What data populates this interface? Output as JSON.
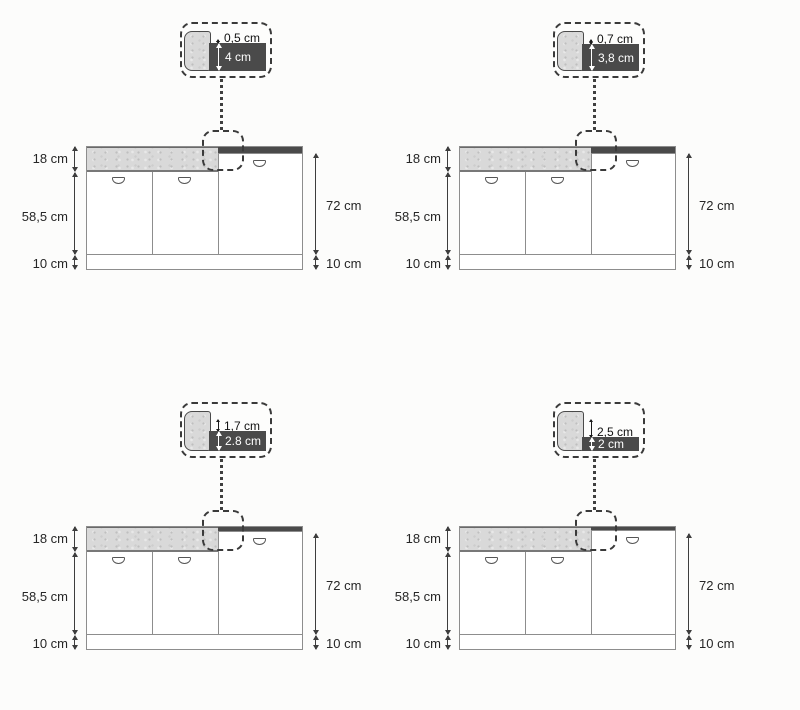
{
  "colors": {
    "worktop_dark": "#4a4a4a",
    "counter_gray": "#d9d9d9",
    "dashed_outline": "#3a3a3a",
    "dimension_line": "#3d3d3d",
    "background": "#fcfcfb"
  },
  "diagrams": [
    {
      "callout": {
        "step_label": "0,5 cm",
        "step_cm": 0.5,
        "thickness_label": "4 cm",
        "thickness_cm": 4
      },
      "worktop_cm": 4,
      "dims": {
        "top_section": "18 cm",
        "doors": "58,5 cm",
        "plinth_left": "10 cm",
        "right_height": "72 cm",
        "plinth_right": "10 cm"
      }
    },
    {
      "callout": {
        "step_label": "0,7 cm",
        "step_cm": 0.7,
        "thickness_label": "3,8 cm",
        "thickness_cm": 3.8
      },
      "worktop_cm": 3.8,
      "dims": {
        "top_section": "18 cm",
        "doors": "58,5 cm",
        "plinth_left": "10 cm",
        "right_height": "72 cm",
        "plinth_right": "10 cm"
      }
    },
    {
      "callout": {
        "step_label": "1,7 cm",
        "step_cm": 1.7,
        "thickness_label": "2.8 cm",
        "thickness_cm": 2.8
      },
      "worktop_cm": 2.8,
      "dims": {
        "top_section": "18 cm",
        "doors": "58,5 cm",
        "plinth_left": "10 cm",
        "right_height": "72 cm",
        "plinth_right": "10 cm"
      }
    },
    {
      "callout": {
        "step_label": "2,5 cm",
        "step_cm": 2.5,
        "thickness_label": "2 cm",
        "thickness_cm": 2
      },
      "worktop_cm": 2,
      "dims": {
        "top_section": "18 cm",
        "doors": "58,5 cm",
        "plinth_left": "10 cm",
        "right_height": "72 cm",
        "plinth_right": "10 cm"
      }
    }
  ]
}
